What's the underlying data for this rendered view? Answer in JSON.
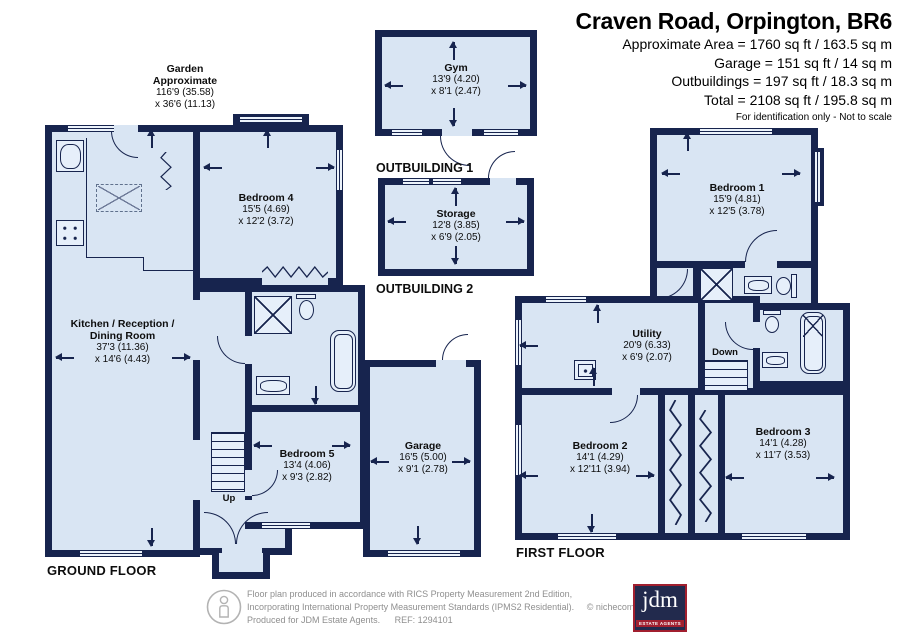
{
  "header": {
    "title": "Craven Road, Orpington, BR6",
    "area_lines": [
      "Approximate Area = 1760 sq ft / 163.5 sq m",
      "Garage = 151 sq ft / 14 sq m",
      "Outbuildings = 197 sq ft / 18.3 sq m",
      "Total = 2108 sq ft / 195.8 sq m"
    ],
    "note": "For identification only - Not to scale"
  },
  "garden": {
    "line1": "Garden",
    "line2": "Approximate",
    "dim1": "116'9 (35.58)",
    "dim2": "x 36'6 (11.13)"
  },
  "floors": {
    "ground": {
      "label": "GROUND FLOOR"
    },
    "first": {
      "label": "FIRST FLOOR"
    }
  },
  "outbuildings": {
    "one": {
      "label": "OUTBUILDING 1",
      "room": {
        "name": "Gym",
        "dim1": "13'9 (4.20)",
        "dim2": "x 8'1 (2.47)"
      }
    },
    "two": {
      "label": "OUTBUILDING 2",
      "room": {
        "name": "Storage",
        "dim1": "12'8 (3.85)",
        "dim2": "x 6'9 (2.05)"
      }
    }
  },
  "rooms": {
    "kitchen": {
      "name1": "Kitchen / Reception /",
      "name2": "Dining Room",
      "dim1": "37'3 (11.36)",
      "dim2": "x 14'6 (4.43)"
    },
    "bedroom4": {
      "name": "Bedroom 4",
      "dim1": "15'5 (4.69)",
      "dim2": "x 12'2 (3.72)"
    },
    "bedroom5": {
      "name": "Bedroom 5",
      "dim1": "13'4 (4.06)",
      "dim2": "x 9'3 (2.82)"
    },
    "garage": {
      "name": "Garage",
      "dim1": "16'5 (5.00)",
      "dim2": "x 9'1 (2.78)"
    },
    "bedroom1": {
      "name": "Bedroom 1",
      "dim1": "15'9 (4.81)",
      "dim2": "x 12'5 (3.78)"
    },
    "utility": {
      "name": "Utility",
      "dim1": "20'9 (6.33)",
      "dim2": "x 6'9 (2.07)"
    },
    "bedroom2": {
      "name": "Bedroom 2",
      "dim1": "14'1 (4.29)",
      "dim2": "x 12'11 (3.94)"
    },
    "bedroom3": {
      "name": "Bedroom 3",
      "dim1": "14'1 (4.28)",
      "dim2": "x 11'7 (3.53)"
    }
  },
  "stairs": {
    "up": "Up",
    "down": "Down"
  },
  "footer": {
    "line1": "Floor plan produced in accordance with RICS Property Measurement 2nd Edition,",
    "line2": "Incorporating International Property Measurement Standards (IPMS2 Residential).",
    "copyright": "© nichecom 2025.",
    "line3": "Produced for JDM Estate Agents.",
    "ref": "REF: 1294101",
    "logo": {
      "text": "jdm",
      "subtext": "ESTATE AGENTS"
    }
  },
  "colors": {
    "wall": "#17244e",
    "room_fill": "#d9e5f3",
    "logo_bg": "#222a4d",
    "logo_accent": "#a11f2f"
  }
}
